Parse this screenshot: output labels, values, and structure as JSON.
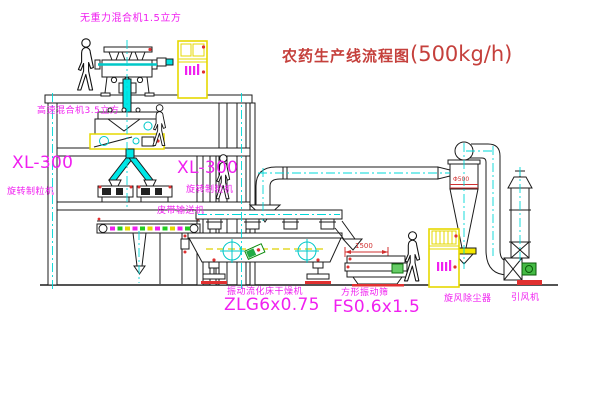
{
  "title": {
    "main": "农药生产线流程图",
    "capacity": "(500kg/h)"
  },
  "labels": {
    "zero_gravity_mixer": "无重力混合机1.5立方",
    "high_speed_mixer": "高速混合机3.5立方",
    "granulator_left_model": "XL-300",
    "granulator_left_name": "旋转制粒机",
    "granulator_right_model": "XL-300",
    "granulator_right_name": "旋转制粒机",
    "belt_conveyor": "皮带输送机",
    "dryer_name": "振动流化床干燥机",
    "dryer_model": "ZLG6x0.75",
    "sieve_name": "方形振动筛",
    "sieve_model": "FS0.6x1.5",
    "cyclone_name": "旋风除尘器",
    "fan_name": "引风机"
  },
  "dimensions": {
    "sieve_length": "1500",
    "cyclone_diameter": "Φ500"
  },
  "colors": {
    "label_magenta": "#f020f0",
    "title_red": "#c5403c",
    "pipe_cyan": "#00e0e0",
    "cabinet_yellow": "#e6d800",
    "alert_red": "#e03030",
    "motor_green": "#44bb44"
  }
}
